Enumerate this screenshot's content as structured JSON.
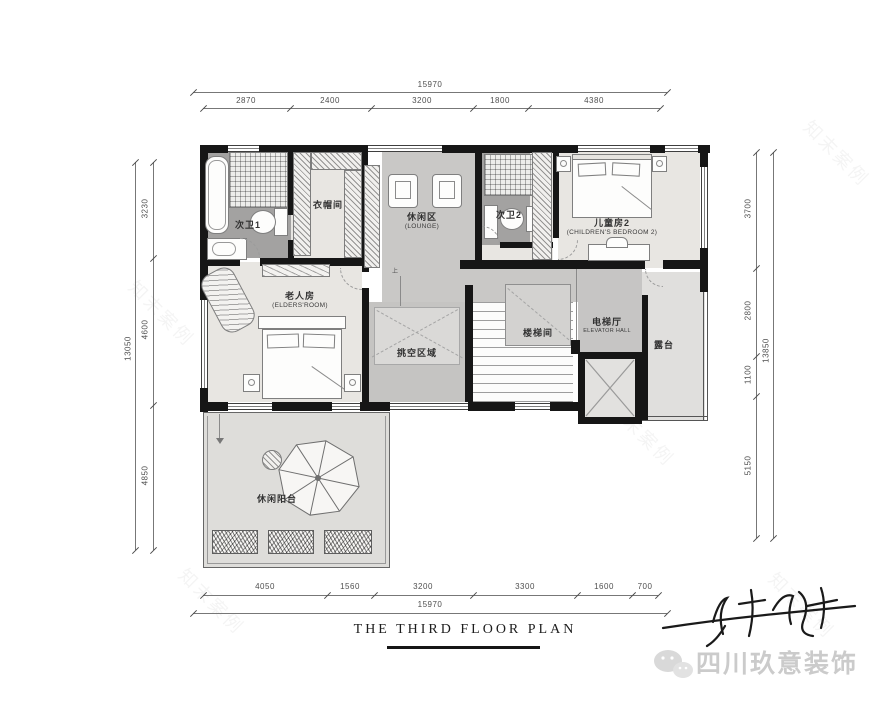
{
  "title": {
    "text": "THE THIRD FLOOR PLAN"
  },
  "dimensions": {
    "top": {
      "overall": "15970",
      "segments": [
        "2870",
        "2400",
        "3200",
        "1800",
        "4380"
      ]
    },
    "bottom": {
      "overall": "15970",
      "segments": [
        "4050",
        "1560",
        "3200",
        "3300",
        "1600",
        "700"
      ]
    },
    "left": {
      "overall": "13050",
      "segments": [
        "3230",
        "4600",
        "4850"
      ]
    },
    "right": {
      "overall": "13850",
      "segments": [
        "3700",
        "2800",
        "1100",
        "5150"
      ]
    }
  },
  "rooms": {
    "bath1": {
      "name": "次卫1"
    },
    "closet": {
      "name": "衣帽间"
    },
    "lounge": {
      "name": "休闲区",
      "name_en": "(LOUNGE)"
    },
    "bath2": {
      "name": "次卫2"
    },
    "children2": {
      "name": "儿童房2",
      "name_en": "(CHILDREN'S BEDROOM 2)"
    },
    "elders": {
      "name": "老人房",
      "name_en": "(ELDERS'ROOM)"
    },
    "void": {
      "name": "挑空区域"
    },
    "stair": {
      "name": "楼梯间"
    },
    "elevator_hall": {
      "name": "电梯厅",
      "name_en": "ELEVATOR HALL"
    },
    "terrace": {
      "name": "露台"
    },
    "balcony": {
      "name": "休闲阳台"
    }
  },
  "annotations": {
    "up": "上"
  },
  "footer": {
    "brand": "四川玖意装饰"
  },
  "watermark": {
    "text": "知末案例"
  },
  "colors": {
    "wall": "#161616",
    "floor_beige": "#e8e6e2",
    "floor_bath": "#a3a2a1",
    "floor_mid": "#c9c8c6",
    "floor_void": "#c5c4c2",
    "floor_light": "#dfdedb",
    "brand_gray": "#cbcbcb"
  }
}
